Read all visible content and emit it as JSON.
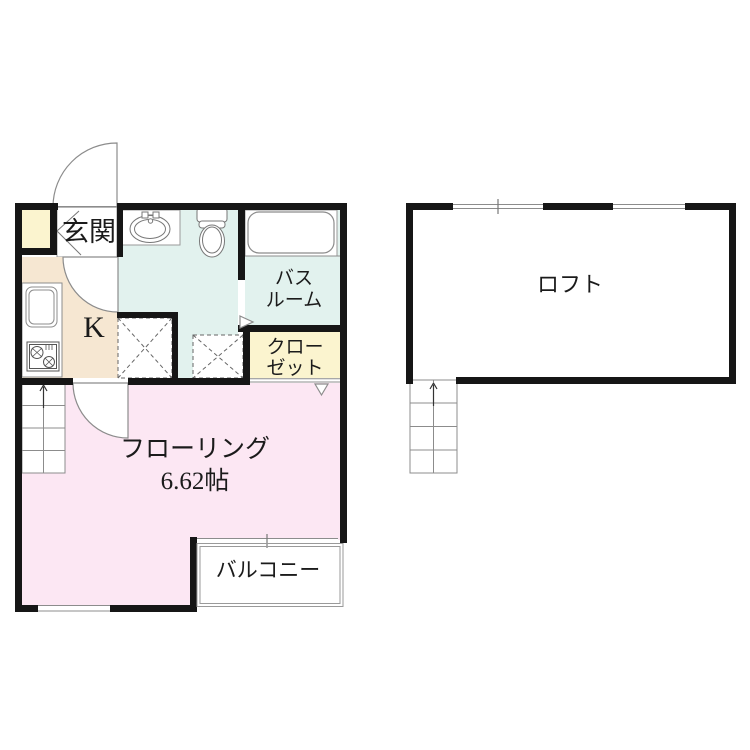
{
  "floor_plan": {
    "unit": {
      "entrance_label": "玄関",
      "kitchen_label": "K",
      "bathroom_label_line1": "バス",
      "bathroom_label_line2": "ルーム",
      "closet_label_line1": "クロー",
      "closet_label_line2": "ゼット",
      "main_room_label": "フローリング",
      "main_room_size": "6.62帖",
      "balcony_label": "バルコニー"
    },
    "loft": {
      "label": "ロフト"
    },
    "colors": {
      "room_pink": "#fce7f3",
      "water_area_cyan": "#e2f2ee",
      "kitchen_beige": "#f6e7d2",
      "storage_yellow": "#fbf4cf",
      "wall_black": "#161616",
      "thin_line_gray": "#8c8c8c"
    }
  }
}
